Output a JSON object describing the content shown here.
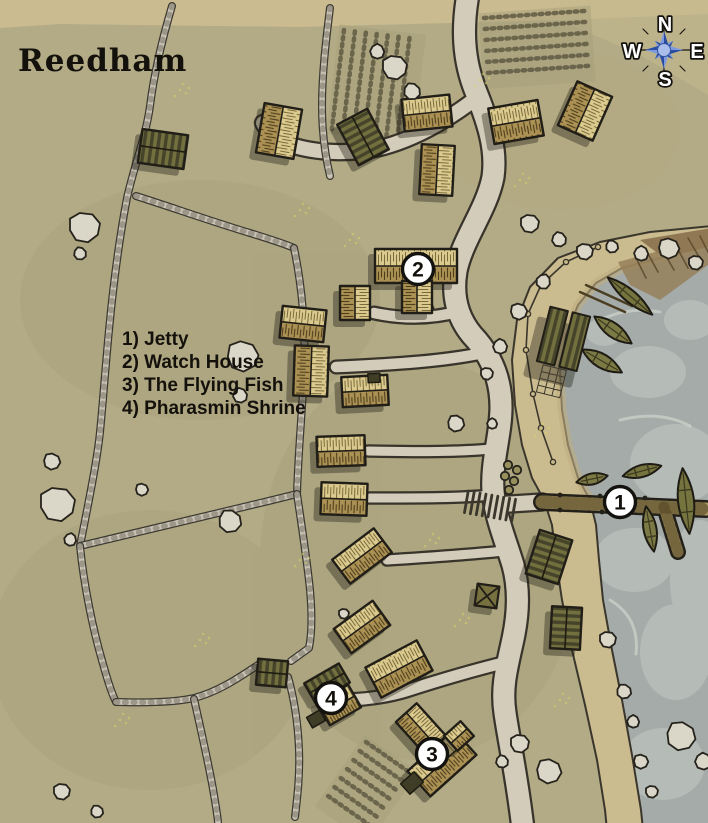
{
  "map": {
    "title": "Reedham",
    "legend": {
      "items": [
        {
          "text": "1) Jetty"
        },
        {
          "text": "2) Watch House"
        },
        {
          "text": "3) The Flying Fish"
        },
        {
          "text": "4) Pharasmin Shrine"
        }
      ]
    },
    "markers": [
      {
        "number": "1",
        "name": "Jetty"
      },
      {
        "number": "2",
        "name": "Watch House"
      },
      {
        "number": "3",
        "name": "The Flying Fish"
      },
      {
        "number": "4",
        "name": "Pharasmin Shrine"
      }
    ],
    "compass": {
      "north": "N",
      "east": "E",
      "south": "S",
      "west": "W"
    },
    "icons": {
      "compass_rose_icon": "eight-point-star",
      "location_marker_icon": "numbered-white-circle"
    },
    "colors": {
      "land": "#b2ab86",
      "sand": "#cbbc90",
      "sea": "#a4aba9",
      "road": "#d3ccba",
      "wall": "#c9c4b5",
      "outline": "#211e17",
      "thatch_light": "#dbca8e",
      "thatch_dark": "#ab9153",
      "roof_dark": "#72703e",
      "marker_fill": "#ffffff",
      "compass_blue": "#7e9ade",
      "compass_blue_dark": "#2a4da3",
      "text": "#14110c"
    }
  }
}
